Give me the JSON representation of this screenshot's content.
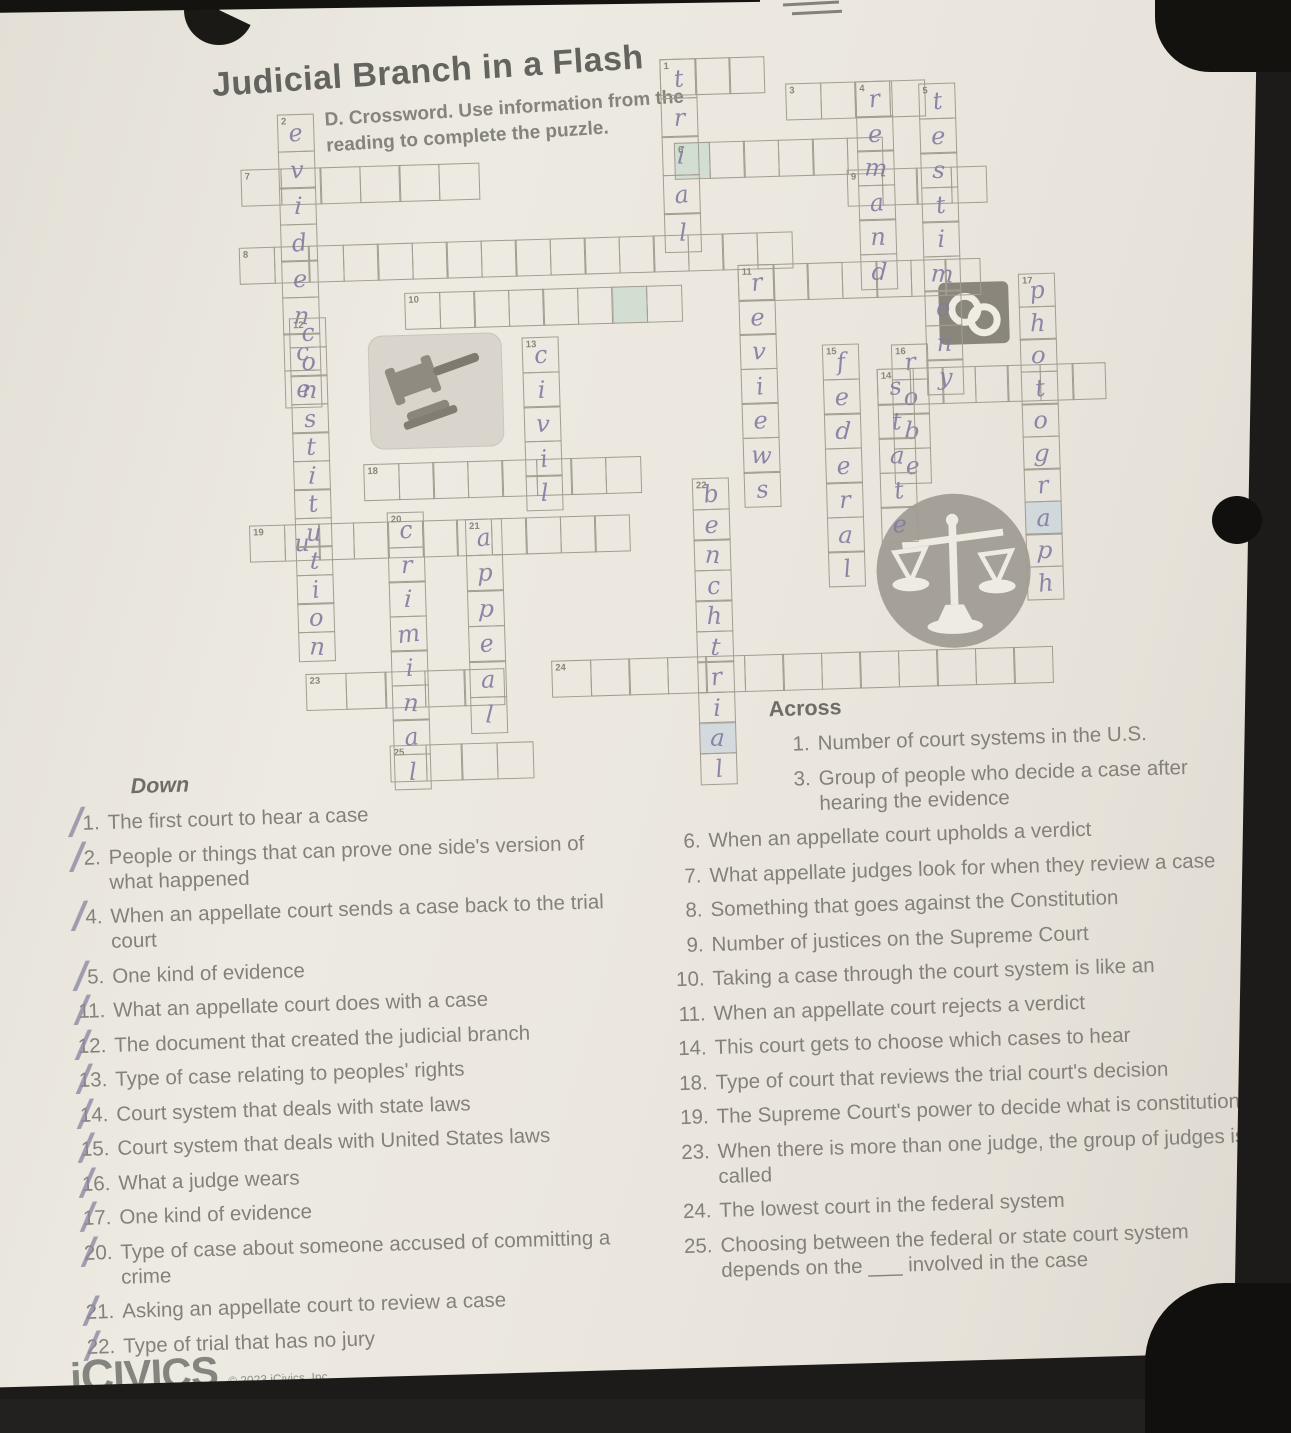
{
  "page": {
    "title": "Judicial Branch in a Flash",
    "subtitle": "D. Crossword. Use information from the reading to complete the puzzle."
  },
  "handwriting_color": "#837ba0",
  "icons": {
    "gavel": "gavel-icon",
    "scales": "scales-of-justice-icon",
    "handcuffs": "handcuffs-icon",
    "icivics_c": "icivics-c-logo"
  },
  "grid": {
    "across_words": [
      {
        "num": "1",
        "x": 670,
        "y": 60,
        "len": 3,
        "cell": 36,
        "letters": []
      },
      {
        "num": "3",
        "x": 795,
        "y": 88,
        "len": 4,
        "cell": 36,
        "letters": []
      },
      {
        "num": "6",
        "x": 682,
        "y": 144,
        "len": 6,
        "cell": 36,
        "letters": [],
        "hl": {
          "0": "hl-g"
        }
      },
      {
        "num": "9",
        "x": 854,
        "y": 176,
        "len": 4,
        "cell": 36,
        "letters": []
      },
      {
        "num": "7",
        "x": 248,
        "y": 158,
        "len": 6,
        "cell": 41,
        "letters": []
      },
      {
        "num": "8",
        "x": 244,
        "y": 236,
        "len": 16,
        "cell": 36,
        "letters": []
      },
      {
        "num": "10",
        "x": 408,
        "y": 286,
        "len": 8,
        "cell": 36,
        "letters": [],
        "hl": {
          "6": "hl-g"
        }
      },
      {
        "num": "11",
        "x": 742,
        "y": 268,
        "len": 7,
        "cell": 36,
        "letters": []
      },
      {
        "num": "14",
        "x": 878,
        "y": 376,
        "len": 7,
        "cell": 34,
        "letters": []
      },
      {
        "num": "18",
        "x": 362,
        "y": 456,
        "len": 8,
        "cell": 36,
        "letters": []
      },
      {
        "num": "19",
        "x": 246,
        "y": 514,
        "len": 11,
        "cell": 36,
        "letters": [
          "",
          "u",
          "",
          "",
          "",
          "",
          "",
          "",
          "",
          "",
          ""
        ]
      },
      {
        "num": "23",
        "x": 298,
        "y": 664,
        "len": 5,
        "cell": 41,
        "letters": []
      },
      {
        "num": "24",
        "x": 544,
        "y": 658,
        "len": 13,
        "cell": 40,
        "letters": []
      },
      {
        "num": "25",
        "x": 380,
        "y": 738,
        "len": 4,
        "cell": 37,
        "letters": []
      }
    ],
    "down_words": [
      {
        "num": "1",
        "x": 670,
        "y": 60,
        "len": 5,
        "cell": 40,
        "letters": [
          "t",
          "r",
          "i",
          "a",
          "l"
        ],
        "shownum": false
      },
      {
        "num": "2",
        "x": 286,
        "y": 104,
        "len": 8,
        "cell": 38,
        "letters": [
          "e",
          "v",
          "i",
          "d",
          "e",
          "n",
          "c",
          "e"
        ]
      },
      {
        "num": "4",
        "x": 865,
        "y": 88,
        "len": 6,
        "cell": 36,
        "letters": [
          "r",
          "e",
          "m",
          "a",
          "n",
          "d"
        ]
      },
      {
        "num": "5",
        "x": 928,
        "y": 92,
        "len": 9,
        "cell": 36,
        "letters": [
          "t",
          "e",
          "s",
          "t",
          "i",
          "m",
          "o",
          "n",
          "y"
        ]
      },
      {
        "num": "11",
        "x": 742,
        "y": 268,
        "len": 7,
        "cell": 36,
        "letters": [
          "r",
          "e",
          "v",
          "i",
          "e",
          "w",
          "s"
        ],
        "shownum": false
      },
      {
        "num": "12",
        "x": 292,
        "y": 308,
        "len": 12,
        "cell": 30,
        "letters": [
          "c",
          "o",
          "n",
          "s",
          "t",
          "i",
          "t",
          "u",
          "t",
          "i",
          "o",
          "n"
        ]
      },
      {
        "num": "13",
        "x": 524,
        "y": 334,
        "len": 5,
        "cell": 36,
        "letters": [
          "c",
          "i",
          "v",
          "i",
          "l"
        ]
      },
      {
        "num": "15",
        "x": 824,
        "y": 350,
        "len": 7,
        "cell": 36,
        "letters": [
          "f",
          "e",
          "d",
          "e",
          "r",
          "a",
          "l"
        ]
      },
      {
        "num": "16",
        "x": 893,
        "y": 352,
        "len": 4,
        "cell": 36,
        "letters": [
          "r",
          "o",
          "b",
          "e"
        ]
      },
      {
        "num": "14",
        "x": 878,
        "y": 376,
        "len": 5,
        "cell": 36,
        "letters": [
          "s",
          "t",
          "a",
          "t",
          "e"
        ],
        "shownum": false
      },
      {
        "num": "17",
        "x": 1022,
        "y": 285,
        "len": 10,
        "cell": 34,
        "letters": [
          "p",
          "h",
          "o",
          "t",
          "o",
          "g",
          "r",
          "a",
          "p",
          "h"
        ],
        "hl": {
          "7": "hl-b"
        }
      },
      {
        "num": "20",
        "x": 384,
        "y": 505,
        "len": 8,
        "cell": 36,
        "letters": [
          "c",
          "r",
          "i",
          "m",
          "i",
          "n",
          "a",
          "l"
        ]
      },
      {
        "num": "21",
        "x": 462,
        "y": 514,
        "len": 6,
        "cell": 37,
        "letters": [
          "a",
          "p",
          "p",
          "e",
          "a",
          "l"
        ]
      },
      {
        "num": "22",
        "x": 690,
        "y": 480,
        "len": 10,
        "cell": 32,
        "letters": [
          "b",
          "e",
          "n",
          "c",
          "h",
          "t",
          "r",
          "i",
          "a",
          "l"
        ],
        "hl": {
          "8": "hl-b"
        }
      }
    ]
  },
  "clues": {
    "across_label": "Across",
    "down_label": "Down",
    "across": [
      {
        "n": "1.",
        "text": "Number of court systems in the U.S.",
        "indent": true
      },
      {
        "n": "3.",
        "text": "Group of people who decide a case after hearing the evidence",
        "indent": true
      },
      {
        "n": "6.",
        "text": "When an appellate court upholds a verdict"
      },
      {
        "n": "7.",
        "text": "What appellate judges look for when they review a case"
      },
      {
        "n": "8.",
        "text": "Something that goes against the Constitution"
      },
      {
        "n": "9.",
        "text": "Number of justices on the Supreme Court"
      },
      {
        "n": "10.",
        "text": "Taking a case through the court system is like an"
      },
      {
        "n": "11.",
        "text": "When an appellate court rejects a verdict"
      },
      {
        "n": "14.",
        "text": "This court gets to choose which cases to hear"
      },
      {
        "n": "18.",
        "text": "Type of court that reviews the trial court's decision"
      },
      {
        "n": "19.",
        "text": "The Supreme Court's power to decide what is constitutional"
      },
      {
        "n": "23.",
        "text": "When there is more than one judge, the group of judges is called"
      },
      {
        "n": "24.",
        "text": "The lowest court in the federal system"
      },
      {
        "n": "25.",
        "text": "Choosing between the federal or state court system depends on the ___ involved in the case"
      }
    ],
    "down": [
      {
        "n": "1.",
        "text": "The first court to hear a case",
        "checked": true
      },
      {
        "n": "2.",
        "text": "People or things that can prove one side's version of what happened",
        "checked": true
      },
      {
        "n": "4.",
        "text": "When an appellate court sends a case back to the trial court",
        "checked": true
      },
      {
        "n": "5.",
        "text": "One kind of evidence",
        "checked": true
      },
      {
        "n": "11.",
        "text": "What an appellate court does with a case",
        "checked": true
      },
      {
        "n": "12.",
        "text": "The document that created the judicial branch",
        "checked": true
      },
      {
        "n": "13.",
        "text": "Type of case relating to peoples' rights",
        "checked": true
      },
      {
        "n": "14.",
        "text": "Court system that deals with state laws",
        "checked": true
      },
      {
        "n": "15.",
        "text": "Court system that deals with United States laws",
        "checked": true
      },
      {
        "n": "16.",
        "text": "What a judge wears",
        "checked": true
      },
      {
        "n": "17.",
        "text": "One kind of evidence",
        "checked": true
      },
      {
        "n": "20.",
        "text": "Type of case about someone accused of committing a crime",
        "checked": true
      },
      {
        "n": "21.",
        "text": "Asking an appellate court to review a case",
        "checked": true
      },
      {
        "n": "22.",
        "text": "Type of trial that has no jury",
        "checked": true
      }
    ]
  },
  "branding": {
    "logo_i": "i",
    "logo_c": "C",
    "logo_rest": "IVICS",
    "copyright": "© 2023 iCivics, Inc."
  }
}
